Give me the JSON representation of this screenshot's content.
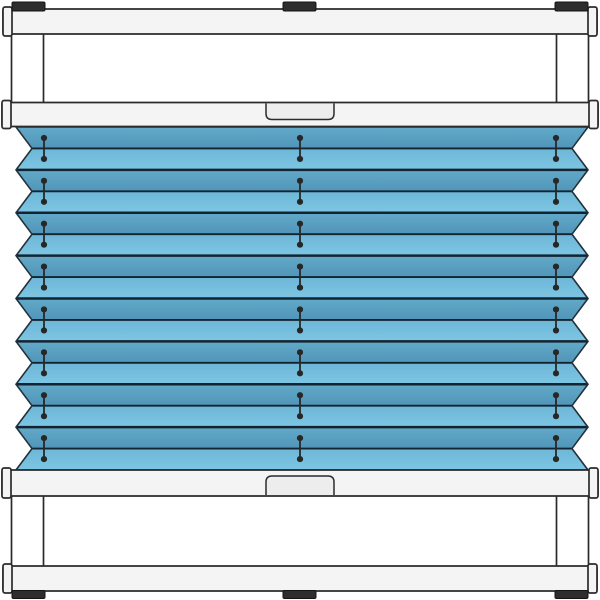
{
  "illustration": {
    "name": "pleated-blind-clamp-mounted-on-window-sash",
    "canvas": {
      "width": 600,
      "height": 600,
      "background": "#ffffff"
    },
    "colors": {
      "outline": "#2b2b2b",
      "frame_fill": "#f4f4f4",
      "member_fill": "#ffffff",
      "bracket_fill": "#2d2d2d",
      "handle_fill": "#ededed",
      "pleat_dark_top": "#62aac9",
      "pleat_dark_bottom": "#5195b8",
      "pleat_light_top": "#6db6d7",
      "pleat_light_bottom": "#7dc6e3",
      "crease_line": "#132430",
      "fabric_outline": "#22313c",
      "cord_color": "#272727"
    },
    "window_frame": {
      "top_beam": {
        "x": 3,
        "y": 9,
        "w": 594,
        "h": 25
      },
      "bottom_beam": {
        "x": 3,
        "y": 566,
        "w": 594,
        "h": 25
      },
      "beam_cap": {
        "w": 9,
        "extra": 2
      },
      "brackets": {
        "y": 2,
        "h": 9,
        "xs": [
          [
            12,
            45
          ],
          [
            283,
            316
          ],
          [
            555,
            588
          ]
        ]
      },
      "feet": {
        "y": 590.5,
        "h": 8,
        "xs": [
          [
            12,
            45
          ],
          [
            283,
            316
          ],
          [
            555,
            588
          ]
        ]
      },
      "members": {
        "w": 32,
        "x_left": 11.5,
        "x_right": 556.5,
        "top": {
          "y1": 32,
          "y2": 104
        },
        "bottom": {
          "y1": 495,
          "y2": 567
        }
      }
    },
    "blind": {
      "top_rail": {
        "x": 2,
        "y": 102.5,
        "w": 596,
        "h": 24
      },
      "bottom_rail": {
        "x": 2,
        "y": 470,
        "w": 596,
        "h": 26
      },
      "rail_cap": {
        "w": 9,
        "extra": 2
      },
      "handle_top": {
        "x": 266,
        "w": 68,
        "h": 17,
        "corner": 6
      },
      "handle_bottom": {
        "x": 266,
        "w": 68,
        "h": 20,
        "corner": 6
      },
      "fabric": {
        "top": 127,
        "bottom": 470,
        "left_outer": 16,
        "left_inner": 32,
        "right_outer": 588,
        "right_inner": 572,
        "band_count": 16,
        "front_crease_width": 2.4,
        "back_crease_width": 1.8
      },
      "cords": {
        "xs": [
          44,
          300,
          556
        ],
        "dot_radius": 3.1,
        "half_len": 10.5,
        "line_width": 1.8
      }
    }
  }
}
